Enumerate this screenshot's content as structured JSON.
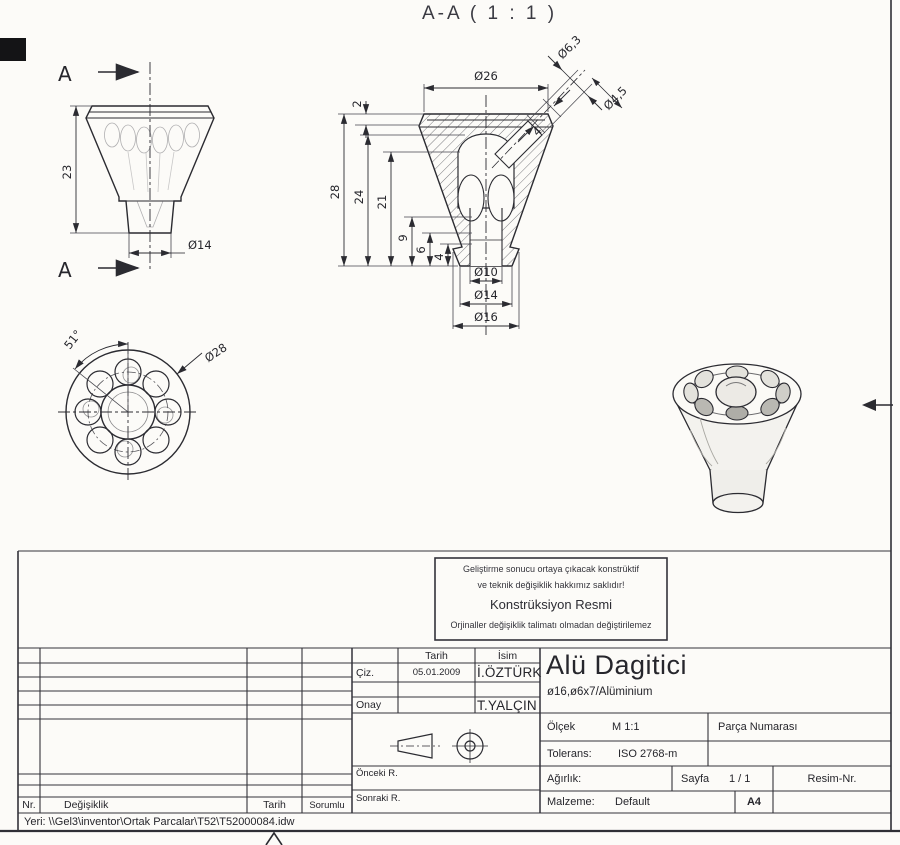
{
  "drawing": {
    "section_title": "A-A ( 1 : 1 )",
    "front_view": {
      "cut_label": "A",
      "height": "23",
      "stem_dia": "Ø14"
    },
    "section_view": {
      "top_dia": "Ø26",
      "top_chamfer": "2",
      "total_height": "28",
      "h24": "24",
      "h21": "21",
      "h9": "9",
      "h6": "6",
      "h4": "4",
      "hole_dia": "Ø10",
      "stem_dia": "Ø14",
      "base_dia": "Ø16",
      "angled_dia_outer": "Ø6,3",
      "angled_dia_inner": "Ø4,5",
      "angled_depth": "4"
    },
    "bottom_view": {
      "angle": "51°",
      "outer_dia": "Ø28"
    }
  },
  "title_block": {
    "notice": {
      "line1": "Geliştirme sonucu ortaya çıkacak konstrüktif",
      "line2": "ve teknik değişiklik hakkımız saklıdır!",
      "line3": "Konstrüksiyon Resmi",
      "line4": "Orjinaller değişiklik talimatı olmadan değiştirilemez"
    },
    "approval": {
      "header_date": "Tarih",
      "header_name": "İsim",
      "rows": [
        {
          "label": "Çiz.",
          "date": "05.01.2009",
          "name": "İ.ÖZTÜRK"
        },
        {
          "label": "Onay",
          "date": "",
          "name": "T.YALÇIN"
        }
      ]
    },
    "revision": {
      "nr": "Nr.",
      "change": "Değişiklik",
      "date": "Tarih",
      "resp": "Sorumlu",
      "prev": "Önceki R.",
      "next": "Sonraki R."
    },
    "part": {
      "title": "Alü Dagitici",
      "subtitle": "ø16,ø6x7/Alüminium"
    },
    "fields": {
      "olcek_label": "Ölçek",
      "olcek_value": "M 1:1",
      "parca_numarasi": "Parça Numarası",
      "tolerans_label": "Tolerans:",
      "tolerans_value": "ISO 2768-m",
      "agirlik_label": "Ağırlık:",
      "sayfa_label": "Sayfa",
      "sayfa_value": "1 / 1",
      "resim_label": "Resim-Nr.",
      "malzeme_label": "Malzeme:",
      "malzeme_value": "Default",
      "format": "A4"
    }
  },
  "footer": {
    "path": "Yeri: \\\\Gel3\\inventor\\Ortak Parcalar\\T52\\T52000084.idw"
  },
  "colors": {
    "ink": "#2b2b31",
    "faint": "#8a8a86"
  }
}
